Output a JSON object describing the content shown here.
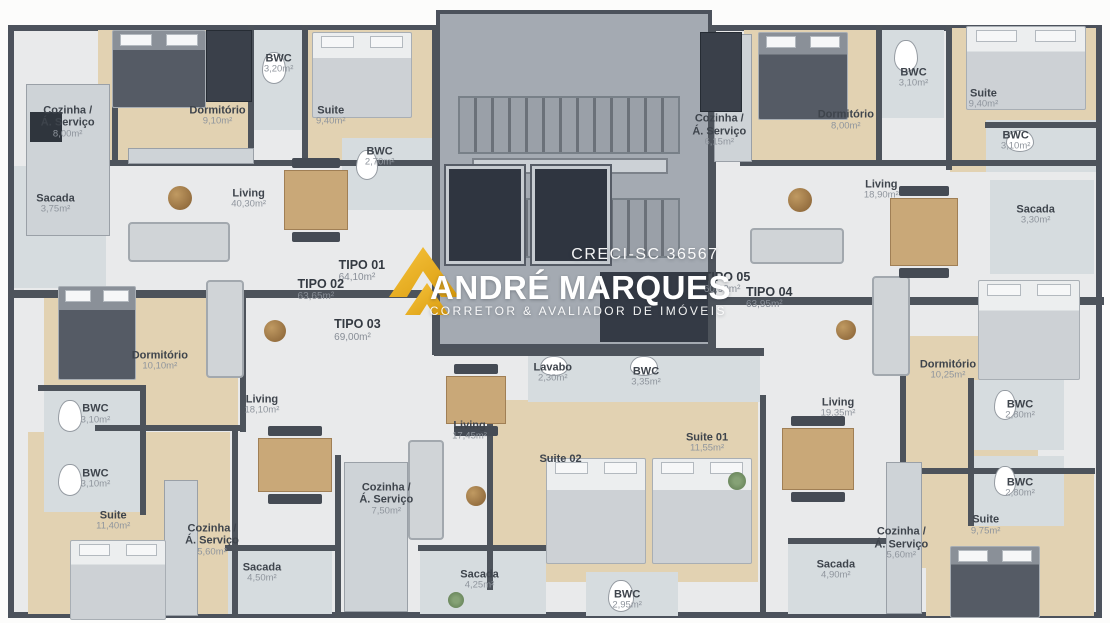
{
  "watermark": {
    "creci": "CRECI-SC 36567",
    "brand_first": "ANDRÉ",
    "brand_second": "MARQUES",
    "tagline": "CORRETOR & AVALIADOR DE IMÓVEIS",
    "gold_color": "#F2B41D",
    "text_color": "#FFFFFF"
  },
  "colors": {
    "walls": "#4D535B",
    "wood_floor": "#E2D2B2",
    "tile_floor": "#D6DCDF",
    "base_floor": "#E9EAEB"
  },
  "units": [
    {
      "id": "tipo-01",
      "name": "TIPO 01",
      "area": "64,10m²",
      "x": 32.6,
      "y": 43.5
    },
    {
      "id": "tipo-02",
      "name": "TIPO 02",
      "area": "63,65m²",
      "x": 28.9,
      "y": 46.5
    },
    {
      "id": "tipo-03",
      "name": "TIPO 03",
      "area": "69,00m²",
      "x": 32.2,
      "y": 53.0
    },
    {
      "id": "tipo-05",
      "name": "TIPO 05",
      "area": "60,90m²",
      "x": 65.5,
      "y": 45.4
    },
    {
      "id": "tipo-04",
      "name": "TIPO 04",
      "area": "63,95m²",
      "x": 69.3,
      "y": 47.8
    }
  ],
  "rooms": [
    {
      "unit": "TIPO 01",
      "name": "Cozinha /",
      "name2": "Á. Serviço",
      "area": "8,00m²",
      "x": 6.1,
      "y": 19.6
    },
    {
      "unit": "TIPO 01",
      "name": "Dormitório",
      "area": "9,10m²",
      "x": 19.6,
      "y": 18.6
    },
    {
      "unit": "TIPO 01",
      "name": "BWC",
      "area": "3,20m²",
      "x": 25.1,
      "y": 10.3
    },
    {
      "unit": "TIPO 01",
      "name": "Suite",
      "area": "9,40m²",
      "x": 29.8,
      "y": 18.6
    },
    {
      "unit": "TIPO 01",
      "name": "BWC",
      "area": "2,70m²",
      "x": 34.2,
      "y": 25.2
    },
    {
      "unit": "TIPO 01",
      "name": "Living",
      "area": "40,30m²",
      "x": 22.4,
      "y": 31.9
    },
    {
      "unit": "TIPO 01",
      "name": "Sacada",
      "area": "3,75m²",
      "x": 5.0,
      "y": 32.7
    },
    {
      "unit": "TIPO 02",
      "name": "Dormitório",
      "area": "10,10m²",
      "x": 14.4,
      "y": 57.9
    },
    {
      "unit": "TIPO 02",
      "name": "Living",
      "area": "18,10m²",
      "x": 23.6,
      "y": 65.0
    },
    {
      "unit": "TIPO 02",
      "name": "BWC",
      "area": "3,10m²",
      "x": 8.6,
      "y": 66.5
    },
    {
      "unit": "TIPO 02",
      "name": "BWC",
      "area": "3,10m²",
      "x": 8.6,
      "y": 76.9
    },
    {
      "unit": "TIPO 02",
      "name": "Suite",
      "area": "11,40m²",
      "x": 10.2,
      "y": 83.6
    },
    {
      "unit": "TIPO 02",
      "name": "Cozinha /",
      "name2": "Á. Serviço",
      "area": "5,60m²",
      "x": 19.1,
      "y": 86.7
    },
    {
      "unit": "TIPO 02",
      "name": "Sacada",
      "area": "4,50m²",
      "x": 23.6,
      "y": 92.0
    },
    {
      "unit": "TIPO 03",
      "name": "Lavabo",
      "area": "2,30m²",
      "x": 49.8,
      "y": 59.9
    },
    {
      "unit": "TIPO 03",
      "name": "BWC",
      "area": "3,35m²",
      "x": 58.2,
      "y": 60.5
    },
    {
      "unit": "TIPO 03",
      "name": "Living",
      "area": "17,45m²",
      "x": 42.3,
      "y": 69.2
    },
    {
      "unit": "TIPO 03",
      "name": "Suite 02",
      "x": 50.5,
      "y": 73.7
    },
    {
      "unit": "TIPO 03",
      "name": "Suite 01",
      "area": "11,55m²",
      "x": 63.7,
      "y": 71.1
    },
    {
      "unit": "TIPO 03",
      "name": "Cozinha /",
      "name2": "Á. Serviço",
      "area": "7,50m²",
      "x": 34.8,
      "y": 80.1
    },
    {
      "unit": "TIPO 03",
      "name": "Sacada",
      "area": "4,25m²",
      "x": 43.2,
      "y": 93.1
    },
    {
      "unit": "TIPO 03",
      "name": "BWC",
      "area": "2,95m²",
      "x": 56.5,
      "y": 96.3
    },
    {
      "unit": "TIPO 05",
      "name": "Cozinha /",
      "name2": "Á. Serviço",
      "area": "6,15m²",
      "x": 64.8,
      "y": 20.9
    },
    {
      "unit": "TIPO 05",
      "name": "Dormitório",
      "area": "8,00m²",
      "x": 76.2,
      "y": 19.3
    },
    {
      "unit": "TIPO 05",
      "name": "BWC",
      "area": "3,10m²",
      "x": 82.3,
      "y": 12.5
    },
    {
      "unit": "TIPO 05",
      "name": "Suite",
      "area": "9,40m²",
      "x": 88.6,
      "y": 15.9
    },
    {
      "unit": "TIPO 05",
      "name": "BWC",
      "area": "3,10m²",
      "x": 91.5,
      "y": 22.6
    },
    {
      "unit": "TIPO 05",
      "name": "Living",
      "area": "18,90m²",
      "x": 79.4,
      "y": 30.5
    },
    {
      "unit": "TIPO 05",
      "name": "Sacada",
      "area": "3,30m²",
      "x": 93.3,
      "y": 34.5
    },
    {
      "unit": "TIPO 04",
      "name": "Dormitório",
      "area": "10,25m²",
      "x": 85.4,
      "y": 59.4
    },
    {
      "unit": "TIPO 04",
      "name": "Living",
      "area": "19,35m²",
      "x": 75.5,
      "y": 65.5
    },
    {
      "unit": "TIPO 04",
      "name": "BWC",
      "area": "2,80m²",
      "x": 91.9,
      "y": 65.8
    },
    {
      "unit": "TIPO 04",
      "name": "BWC",
      "area": "2,80m²",
      "x": 91.9,
      "y": 78.3
    },
    {
      "unit": "TIPO 04",
      "name": "Suite",
      "area": "9,75m²",
      "x": 88.8,
      "y": 84.3
    },
    {
      "unit": "TIPO 04",
      "name": "Cozinha /",
      "name2": "Á. Serviço",
      "area": "5,60m²",
      "x": 81.2,
      "y": 87.2
    },
    {
      "unit": "TIPO 04",
      "name": "Sacada",
      "area": "4,90m²",
      "x": 75.3,
      "y": 91.5
    }
  ]
}
